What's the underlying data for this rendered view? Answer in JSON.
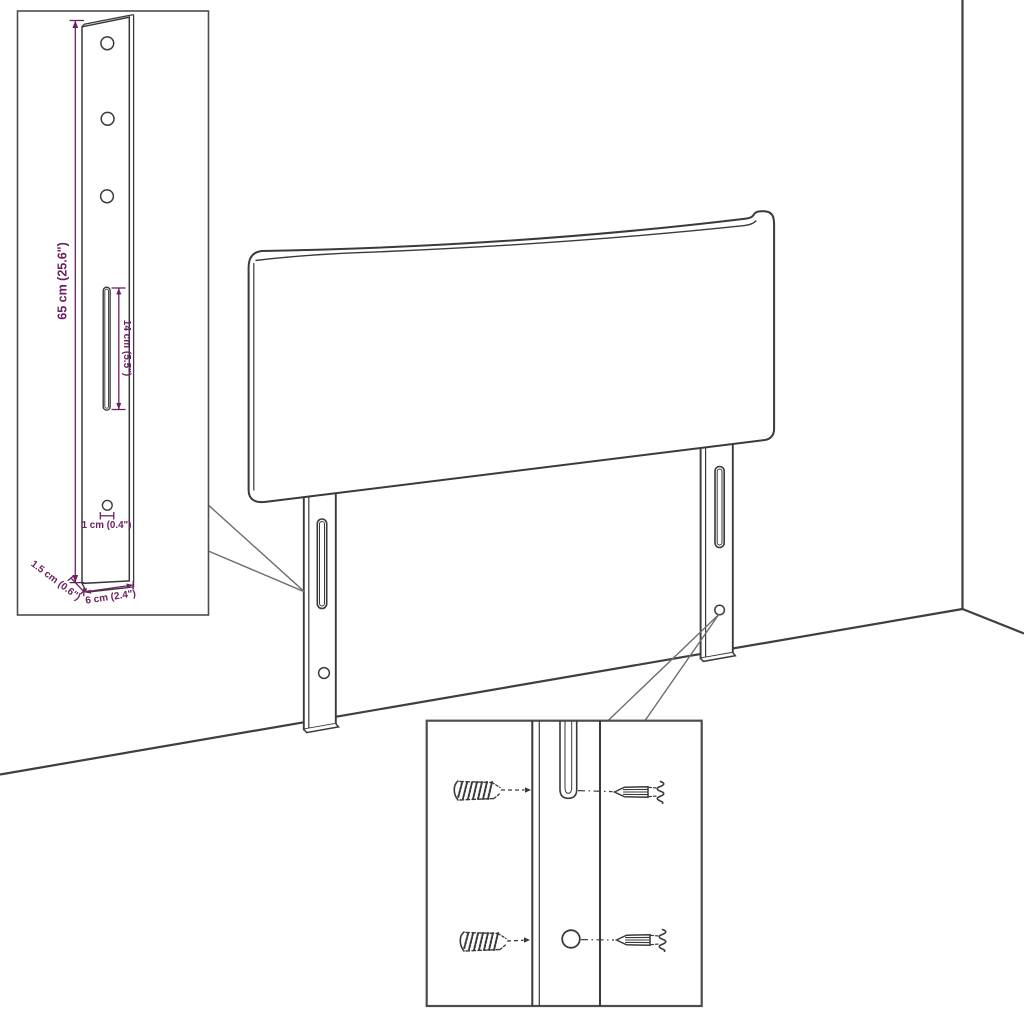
{
  "colors": {
    "background": "#ffffff",
    "drawing_line": "#3a3a3a",
    "inset_border": "#4d4d4d",
    "callout_line": "#6e6e6e",
    "dimension": "#6b2161"
  },
  "bracket_inset": {
    "labels": {
      "height": "65 cm (25.6\")",
      "slot_height": "14 cm (5.5\")",
      "hole_diameter": "1 cm (0.4\")",
      "depth": "1.5 cm (0.6\")",
      "width": "6 cm (2.4\")"
    }
  },
  "mounting_inset": {
    "parts": [
      "wall-anchor",
      "screw",
      "leg-slot",
      "leg-hole"
    ]
  }
}
